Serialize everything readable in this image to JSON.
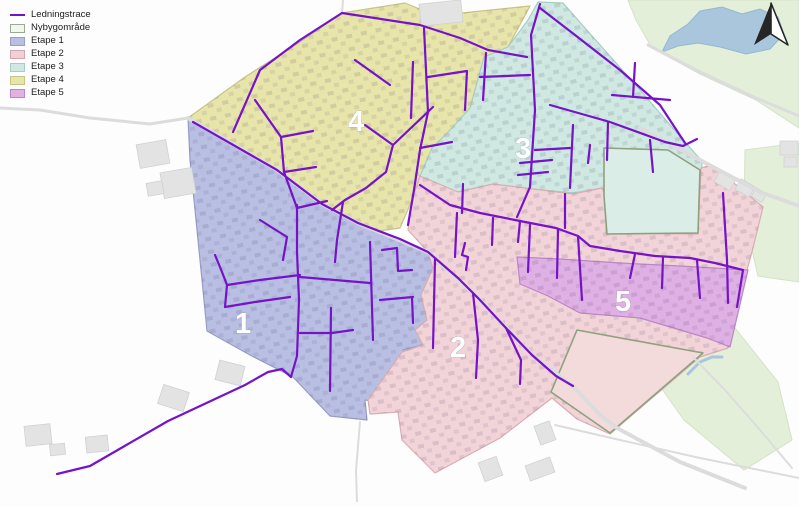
{
  "legend": {
    "items": [
      {
        "label": "Ledningstrace",
        "type": "line",
        "fill": "#7513c9",
        "border": "#7513c9"
      },
      {
        "label": "Nybygområde",
        "type": "area",
        "fill": "#f1f7ec",
        "border": "#9aab91"
      },
      {
        "label": "Etape 1",
        "type": "area",
        "fill": "#b9bfe3",
        "border": "#9a9ec6"
      },
      {
        "label": "Etape 2",
        "type": "area",
        "fill": "#f2cfd5",
        "border": "#d0a7ae"
      },
      {
        "label": "Etape 3",
        "type": "area",
        "fill": "#cfe9e2",
        "border": "#a5cec2"
      },
      {
        "label": "Etape 4",
        "type": "area",
        "fill": "#e8e5ab",
        "border": "#c8c488"
      },
      {
        "label": "Etape 5",
        "type": "area",
        "fill": "#e0b2e4",
        "border": "#bb86c4"
      }
    ]
  },
  "map": {
    "width": 799,
    "height": 502,
    "colors": {
      "background": "#fdfdfd",
      "green": "#e4efd9",
      "lake": "#a9c6dd",
      "lake_stroke": "#93b8d2",
      "road": "#dcdcdc",
      "hedge": "#8fa07f",
      "building": "#e3e3e3",
      "building_stroke": "#d1d1d1",
      "line": "#7513c9",
      "label": "#ffffff"
    },
    "green_areas": [
      [
        628,
        0,
        799,
        0,
        799,
        128,
        756,
        100,
        700,
        74,
        652,
        48,
        636,
        20
      ],
      [
        745,
        150,
        799,
        143,
        799,
        282,
        758,
        276,
        744,
        215
      ],
      [
        658,
        345,
        735,
        328,
        778,
        382,
        792,
        440,
        744,
        470,
        684,
        420,
        657,
        382
      ]
    ],
    "lake": [
      662,
      52,
      670,
      36,
      688,
      24,
      700,
      11,
      722,
      7,
      742,
      14,
      760,
      9,
      778,
      17,
      784,
      34,
      770,
      49,
      746,
      54,
      720,
      47,
      698,
      43,
      678,
      46
    ],
    "stream": [
      688,
      374,
      700,
      362,
      712,
      357,
      722,
      357
    ],
    "zones": [
      {
        "id": "etape-4",
        "name": "Etape 4",
        "fill": "#e8e5ab",
        "stroke": "#c8c488",
        "points": [
          188,
          118,
          245,
          77,
          300,
          42,
          342,
          13,
          405,
          3,
          422,
          10,
          424,
          24,
          462,
          13,
          530,
          6,
          508,
          47,
          484,
          57,
          470,
          108,
          460,
          140,
          445,
          165,
          420,
          176,
          412,
          200,
          400,
          228,
          372,
          232,
          340,
          220,
          305,
          200,
          258,
          158,
          215,
          133
        ],
        "label": {
          "text": "4",
          "x": 348,
          "y": 131
        }
      },
      {
        "id": "etape-3",
        "name": "Etape 3",
        "fill": "#cfe9e2",
        "stroke": "#a5cec2",
        "points": [
          538,
          2,
          563,
          3,
          585,
          28,
          640,
          90,
          683,
          140,
          702,
          161,
          700,
          233,
          606,
          233,
          606,
          197,
          602,
          188,
          573,
          193,
          533,
          189,
          493,
          184,
          458,
          192,
          420,
          176,
          432,
          148,
          452,
          128,
          470,
          108,
          484,
          57,
          508,
          47,
          528,
          20
        ],
        "label": {
          "text": "3",
          "x": 515,
          "y": 158
        }
      },
      {
        "id": "etape-1",
        "name": "Etape 1",
        "fill": "#b9bfe3",
        "stroke": "#989cc5",
        "points": [
          188,
          118,
          277,
          170,
          322,
          204,
          358,
          223,
          400,
          239,
          428,
          252,
          433,
          268,
          421,
          295,
          427,
          320,
          415,
          330,
          423,
          345,
          403,
          350,
          413,
          390,
          393,
          404,
          365,
          400,
          367,
          420,
          330,
          416,
          293,
          377,
          250,
          355,
          207,
          331,
          203,
          290,
          197,
          230,
          190,
          160
        ],
        "label": {
          "text": "1",
          "x": 235,
          "y": 333
        }
      },
      {
        "id": "etape-2",
        "name": "Etape 2",
        "fill": "#f2d4d8",
        "stroke": "#d8aeb4",
        "points": [
          420,
          176,
          458,
          192,
          493,
          184,
          533,
          189,
          573,
          194,
          602,
          188,
          606,
          197,
          606,
          233,
          698,
          234,
          701,
          168,
          712,
          165,
          763,
          207,
          753,
          248,
          747,
          270,
          738,
          308,
          728,
          348,
          700,
          357,
          610,
          434,
          577,
          419,
          552,
          398,
          500,
          438,
          435,
          473,
          402,
          440,
          398,
          412,
          370,
          414,
          368,
          400,
          402,
          352,
          423,
          345,
          415,
          330,
          427,
          320,
          421,
          295,
          433,
          268,
          428,
          252,
          408,
          230,
          412,
          200
        ],
        "label": {
          "text": "2",
          "x": 450,
          "y": 357
        }
      },
      {
        "id": "etape-5",
        "name": "Etape 5",
        "fill": "#dfb0e3",
        "stroke": "#bb86c4",
        "points": [
          517,
          257,
          560,
          259,
          620,
          263,
          680,
          266,
          748,
          270,
          741,
          300,
          730,
          347,
          707,
          338,
          640,
          318,
          580,
          313,
          548,
          296,
          520,
          284
        ],
        "label": {
          "text": "5",
          "x": 615,
          "y": 311
        }
      }
    ],
    "nybyg_areas": [
      {
        "fill": "#daeee7",
        "points": [
          604,
          148,
          668,
          150,
          700,
          170,
          698,
          233,
          607,
          234,
          604,
          196
        ]
      },
      {
        "fill": "#f3dbdb",
        "points": [
          577,
          330,
          703,
          353,
          610,
          433,
          551,
          392
        ]
      }
    ],
    "roads": [
      {
        "width": 3,
        "points": [
          0,
          108,
          40,
          110,
          90,
          118,
          150,
          124,
          188,
          118
        ]
      },
      {
        "width": 4,
        "points": [
          188,
          118,
          277,
          170,
          322,
          204,
          360,
          224,
          428,
          252,
          480,
          300,
          532,
          355,
          573,
          386,
          600,
          415,
          617,
          428,
          680,
          462,
          745,
          488
        ]
      },
      {
        "width": 4,
        "points": [
          640,
          128,
          700,
          160,
          760,
          192,
          799,
          206
        ]
      },
      {
        "width": 3,
        "points": [
          648,
          45,
          700,
          72,
          756,
          98,
          799,
          116
        ]
      },
      {
        "width": 2,
        "points": [
          555,
          425,
          620,
          440,
          700,
          458,
          799,
          478
        ]
      },
      {
        "width": 2,
        "points": [
          693,
          357,
          725,
          390,
          760,
          430,
          792,
          468
        ]
      },
      {
        "width": 2,
        "points": [
          360,
          422,
          356,
          470,
          357,
          502
        ]
      },
      {
        "width": 2,
        "points": [
          343,
          0,
          342,
          13
        ]
      }
    ],
    "buildings": [
      {
        "x": 138,
        "y": 142,
        "w": 30,
        "h": 24,
        "r": -10
      },
      {
        "x": 162,
        "y": 170,
        "w": 32,
        "h": 26,
        "r": -10
      },
      {
        "x": 147,
        "y": 182,
        "w": 16,
        "h": 13,
        "r": -10
      },
      {
        "x": 25,
        "y": 425,
        "w": 26,
        "h": 20,
        "r": -6
      },
      {
        "x": 50,
        "y": 444,
        "w": 15,
        "h": 11,
        "r": -6
      },
      {
        "x": 86,
        "y": 436,
        "w": 22,
        "h": 16,
        "r": -6
      },
      {
        "x": 160,
        "y": 388,
        "w": 27,
        "h": 20,
        "r": 18
      },
      {
        "x": 217,
        "y": 363,
        "w": 26,
        "h": 20,
        "r": 14
      },
      {
        "x": 537,
        "y": 423,
        "w": 16,
        "h": 20,
        "r": -20
      },
      {
        "x": 527,
        "y": 461,
        "w": 26,
        "h": 16,
        "r": -20
      },
      {
        "x": 481,
        "y": 459,
        "w": 19,
        "h": 20,
        "r": -20
      },
      {
        "x": 420,
        "y": 2,
        "w": 42,
        "h": 22,
        "r": -6
      },
      {
        "x": 716,
        "y": 174,
        "w": 18,
        "h": 13,
        "r": 30
      },
      {
        "x": 737,
        "y": 182,
        "w": 16,
        "h": 12,
        "r": 30
      },
      {
        "x": 753,
        "y": 190,
        "w": 12,
        "h": 10,
        "r": 30
      },
      {
        "x": 780,
        "y": 141,
        "w": 18,
        "h": 14,
        "r": 0
      },
      {
        "x": 784,
        "y": 157,
        "w": 13,
        "h": 10,
        "r": 0
      }
    ],
    "lines": [
      [
        57,
        474,
        90,
        466,
        168,
        421,
        245,
        385,
        268,
        372,
        282,
        369,
        291,
        377
      ],
      [
        291,
        377,
        297,
        356,
        299,
        300,
        297,
        252,
        297,
        205
      ],
      [
        193,
        122,
        277,
        170,
        322,
        204,
        358,
        223,
        400,
        239,
        428,
        252,
        458,
        278,
        480,
        300,
        505,
        327,
        532,
        355,
        556,
        376,
        573,
        386
      ],
      [
        342,
        13,
        420,
        25,
        460,
        38,
        488,
        50,
        527,
        57
      ],
      [
        342,
        13,
        300,
        40,
        260,
        70,
        233,
        132
      ],
      [
        255,
        100,
        281,
        137,
        284,
        172,
        297,
        208
      ],
      [
        281,
        137,
        313,
        131
      ],
      [
        284,
        172,
        316,
        167
      ],
      [
        297,
        208,
        327,
        201
      ],
      [
        365,
        125,
        393,
        145,
        386,
        172,
        366,
        188,
        345,
        200,
        332,
        210
      ],
      [
        393,
        145,
        433,
        107
      ],
      [
        413,
        62,
        411,
        118
      ],
      [
        424,
        28,
        428,
        112,
        420,
        150,
        414,
        190,
        408,
        225
      ],
      [
        428,
        77,
        467,
        71
      ],
      [
        420,
        148,
        452,
        142
      ],
      [
        467,
        71,
        465,
        110
      ],
      [
        486,
        53,
        483,
        100
      ],
      [
        355,
        60,
        390,
        85
      ],
      [
        540,
        8,
        575,
        35,
        620,
        70,
        660,
        105,
        685,
        143
      ],
      [
        633,
        97,
        635,
        63
      ],
      [
        540,
        4,
        531,
        35,
        535,
        110,
        530,
        187,
        517,
        217
      ],
      [
        480,
        77,
        530,
        75
      ],
      [
        550,
        105,
        610,
        122,
        665,
        142
      ],
      [
        608,
        122,
        607,
        160
      ],
      [
        650,
        140,
        653,
        172
      ],
      [
        665,
        142,
        683,
        146,
        697,
        139
      ],
      [
        573,
        125,
        570,
        188
      ],
      [
        535,
        150,
        570,
        148
      ],
      [
        518,
        175,
        548,
        172
      ],
      [
        590,
        145,
        588,
        163
      ],
      [
        520,
        163,
        552,
        160
      ],
      [
        612,
        95,
        670,
        100
      ],
      [
        723,
        193,
        727,
        260,
        728,
        303
      ],
      [
        420,
        185,
        450,
        205,
        480,
        213,
        520,
        221,
        556,
        228,
        578,
        236,
        590,
        246,
        620,
        251,
        655,
        256,
        690,
        258,
        715,
        263,
        743,
        270
      ],
      [
        457,
        213,
        455,
        257
      ],
      [
        493,
        218,
        492,
        245
      ],
      [
        520,
        221,
        518,
        242
      ],
      [
        530,
        225,
        528,
        272
      ],
      [
        558,
        230,
        557,
        278
      ],
      [
        578,
        236,
        582,
        300
      ],
      [
        635,
        254,
        630,
        278
      ],
      [
        663,
        257,
        662,
        288
      ],
      [
        697,
        260,
        700,
        298
      ],
      [
        743,
        270,
        737,
        307
      ],
      [
        463,
        184,
        462,
        213
      ],
      [
        565,
        194,
        565,
        228
      ],
      [
        435,
        259,
        433,
        348
      ],
      [
        473,
        293,
        478,
        340,
        476,
        378
      ],
      [
        506,
        328,
        521,
        360,
        520,
        384
      ],
      [
        465,
        243,
        462,
        255,
        468,
        257,
        466,
        270
      ],
      [
        215,
        255,
        222,
        272,
        227,
        285
      ],
      [
        227,
        285,
        260,
        280,
        300,
        275
      ],
      [
        227,
        285,
        225,
        307
      ],
      [
        225,
        307,
        255,
        302,
        290,
        297
      ],
      [
        370,
        242,
        373,
        340
      ],
      [
        300,
        277,
        335,
        280,
        370,
        283
      ],
      [
        382,
        250,
        397,
        248,
        398,
        271,
        412,
        270
      ],
      [
        380,
        300,
        413,
        297
      ],
      [
        412,
        297,
        413,
        323
      ],
      [
        331,
        308,
        330,
        391
      ],
      [
        300,
        333,
        332,
        333,
        353,
        330
      ],
      [
        260,
        220,
        287,
        237
      ],
      [
        287,
        237,
        283,
        260
      ],
      [
        343,
        202,
        337,
        240,
        335,
        262
      ]
    ]
  }
}
